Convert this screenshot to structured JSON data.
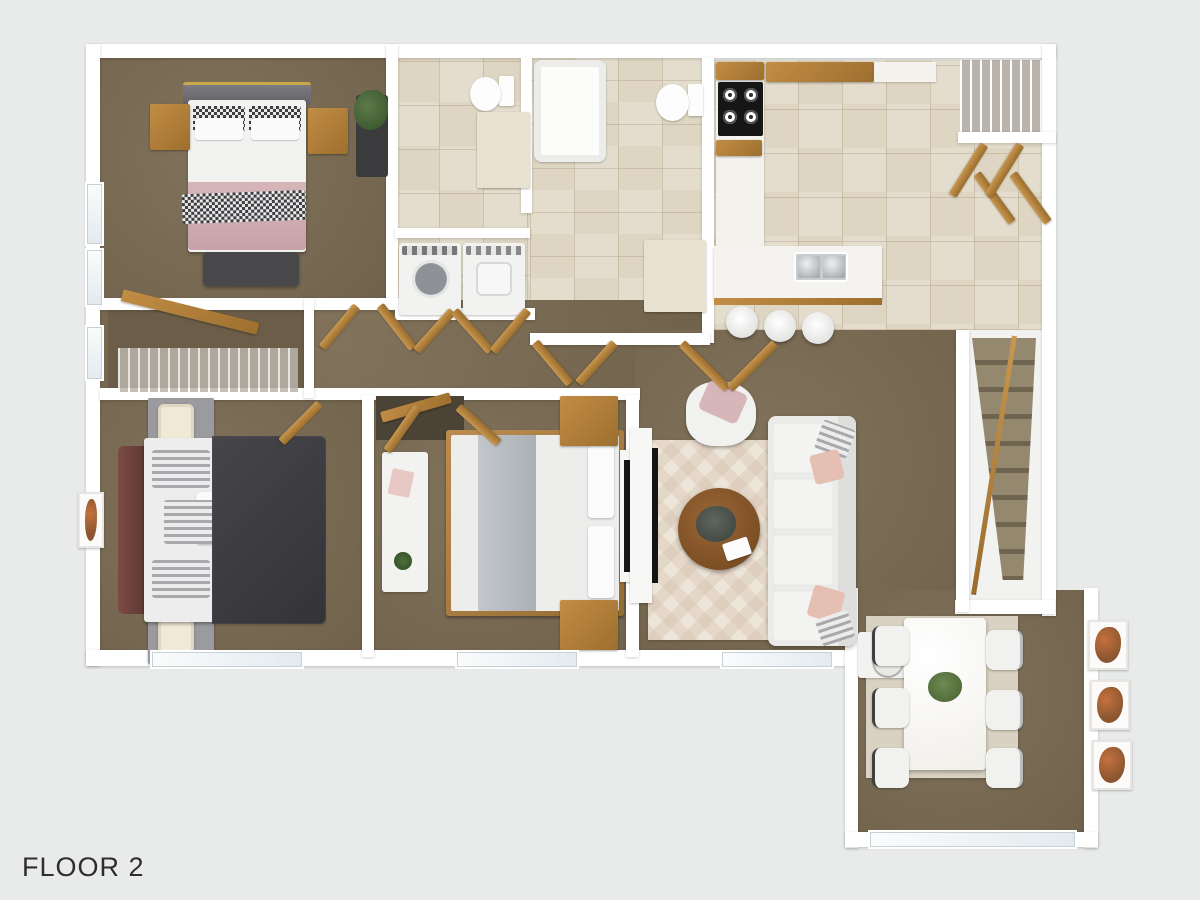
{
  "floor_label": "FLOOR 2",
  "colors": {
    "background": "#e9eaea",
    "wall": "#ffffff",
    "wall_shadow": "#d6d7d7",
    "carpet": "#796a51",
    "carpet_dark": "#6b5d47",
    "tile": "#ded5c2",
    "tile_light": "#ebe4d4",
    "wood": "#b9863f",
    "wood_dark": "#96692b",
    "stove_black": "#161616",
    "fabric_pink": "#d7b6ba",
    "fabric_dark": "#3e3e42",
    "fabric_gray": "#9fa3a9",
    "furn_white": "#f2f2f0",
    "sofa_white": "#ebebe9",
    "rug_light": "#ece5d8",
    "dining_rug": "#d9d2c2",
    "art_orange": "#c4713d",
    "gray_furn": "#9b9b9f",
    "text": "#2e2e2e"
  }
}
